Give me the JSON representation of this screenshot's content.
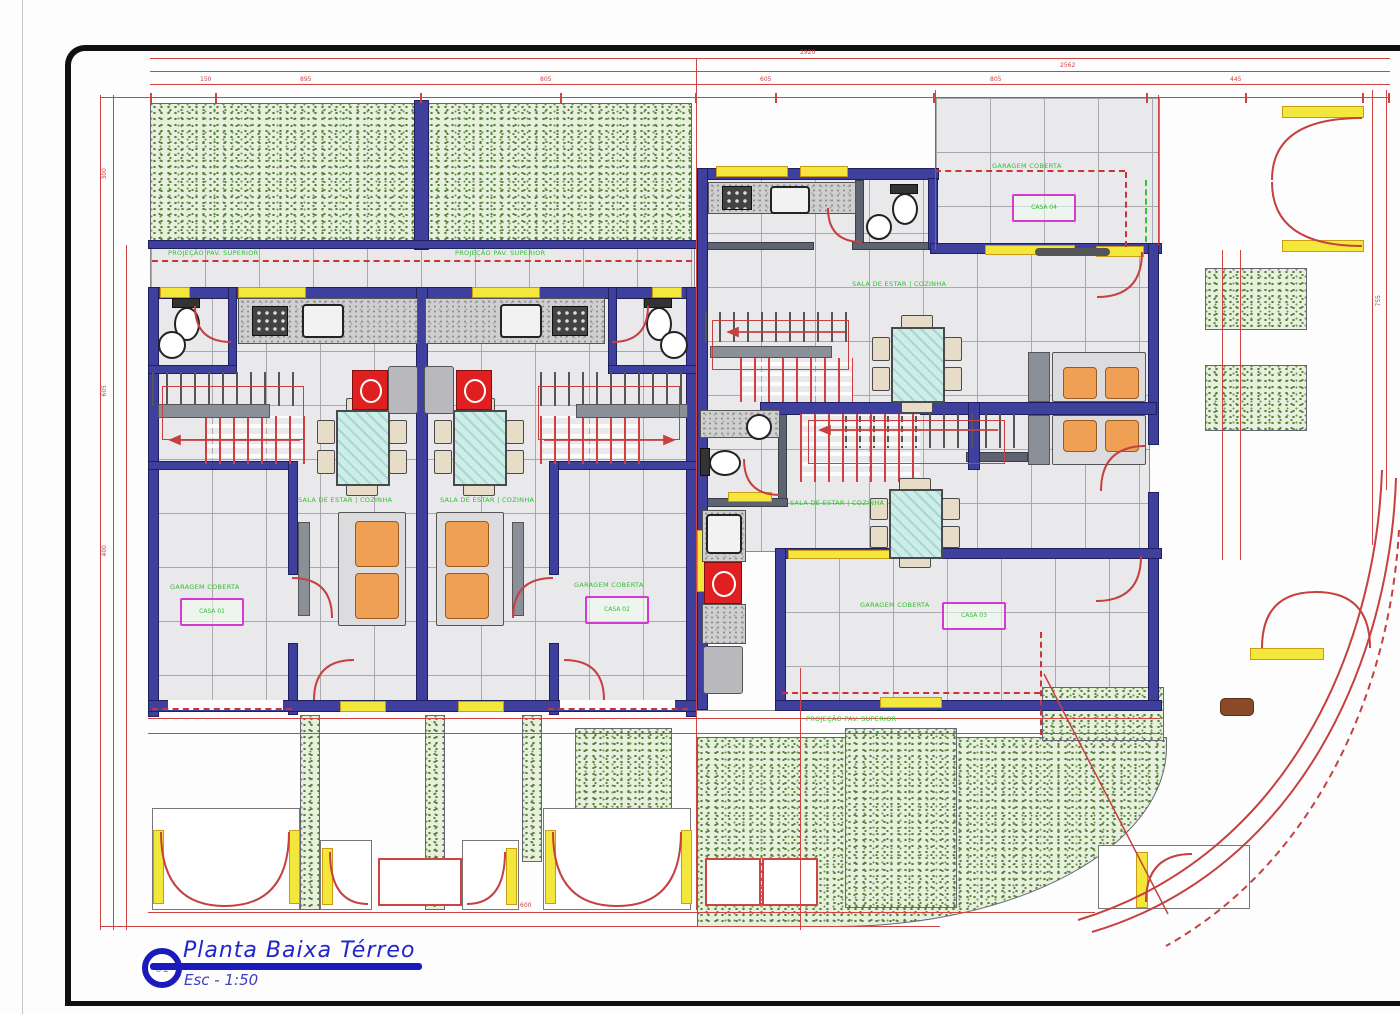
{
  "title_block": {
    "number": "01",
    "title": "Planta Baixa Térreo",
    "scale": "Esc - 1:50"
  },
  "labels": {
    "proj": "PROJEÇÃO PAV. SUPERIOR",
    "garagem": "GARAGEM COBERTA",
    "sala": "SALA DE ESTAR | COZINHA",
    "casa_01": "CASA 01",
    "casa_02": "CASA 02",
    "casa_03": "CASA 03",
    "casa_04": "CASA 04"
  },
  "dims": {
    "w2920": "2920",
    "w2562": "2562",
    "s895": "895",
    "s805": "805",
    "s605": "605",
    "s805b": "805",
    "s445": "445",
    "s150": "150",
    "v300": "300",
    "v605": "605",
    "v400": "400",
    "b600": "600",
    "r755": "755"
  },
  "colors": {
    "wall_indigo": "#3f3f9e",
    "interior_gray": "#5d6370",
    "line_red": "#cf4343",
    "window_yellow": "#f4e73c",
    "hedge_green": "#55813a",
    "glass_teal": "#cdeee8",
    "cushion_orange": "#f0a055",
    "label_green": "#2fbf2f",
    "casa_magenta": "#d23ad2",
    "title_blue": "#2026c8"
  }
}
